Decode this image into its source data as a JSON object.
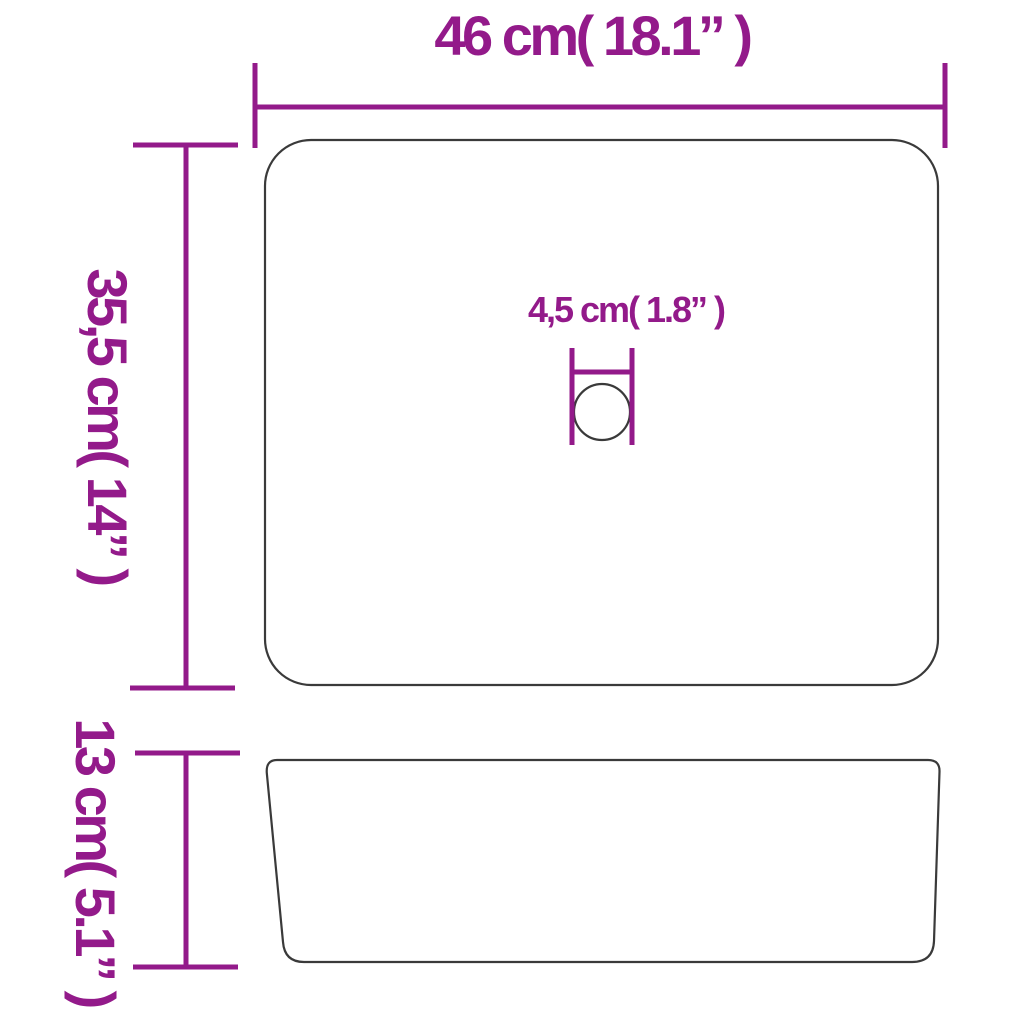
{
  "colors": {
    "dimension": "#931a8a",
    "outline": "#3a3a3a",
    "background": "#ffffff"
  },
  "labels": {
    "width": "46 cm( 18.1”  )",
    "depth": "35,5 cm( 14”  )",
    "drain": "4,5 cm( 1.8”  )",
    "height": "13 cm( 5.1”  )"
  }
}
